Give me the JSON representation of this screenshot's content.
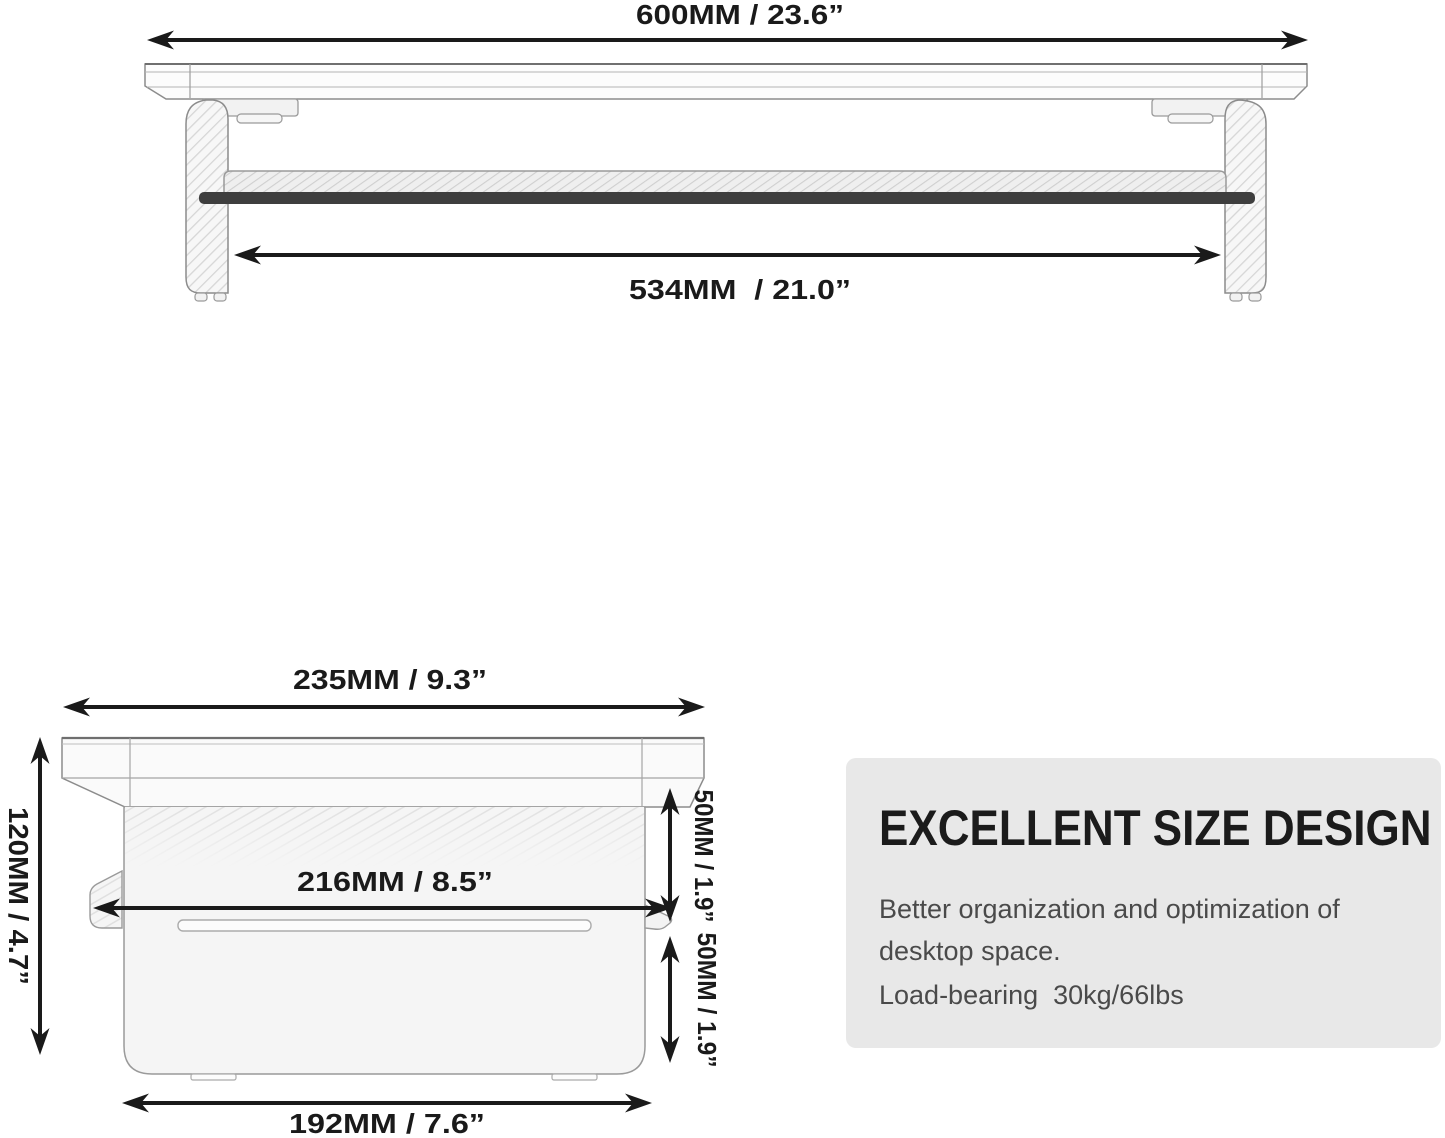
{
  "front_view": {
    "width_label": "600MM / 23.6”",
    "inner_width_label": "534MM  / 21.0”"
  },
  "side_view": {
    "depth_label": "235MM / 9.3”",
    "height_label": "120MM / 4.7”",
    "inner_depth_label": "216MM / 8.5”",
    "upper_gap_label": "50MM / 1.9”",
    "lower_gap_label": "50MM / 1.9”",
    "base_depth_label": "192MM / 7.6”"
  },
  "info_card": {
    "title": "EXCELLENT SIZE DESIGN",
    "body_line1": "Better organization and optimization of",
    "body_line2": "desktop space.",
    "body_line3": "Load-bearing  30kg/66lbs"
  },
  "colors": {
    "background": "#ffffff",
    "dimension_ink": "#1a1a1a",
    "outline": "#8c8c8c",
    "shelf_strip": "#3e3e3e",
    "card_background": "#e8e8e8",
    "card_title": "#1b1b1b",
    "card_body": "#4a4a4a"
  }
}
